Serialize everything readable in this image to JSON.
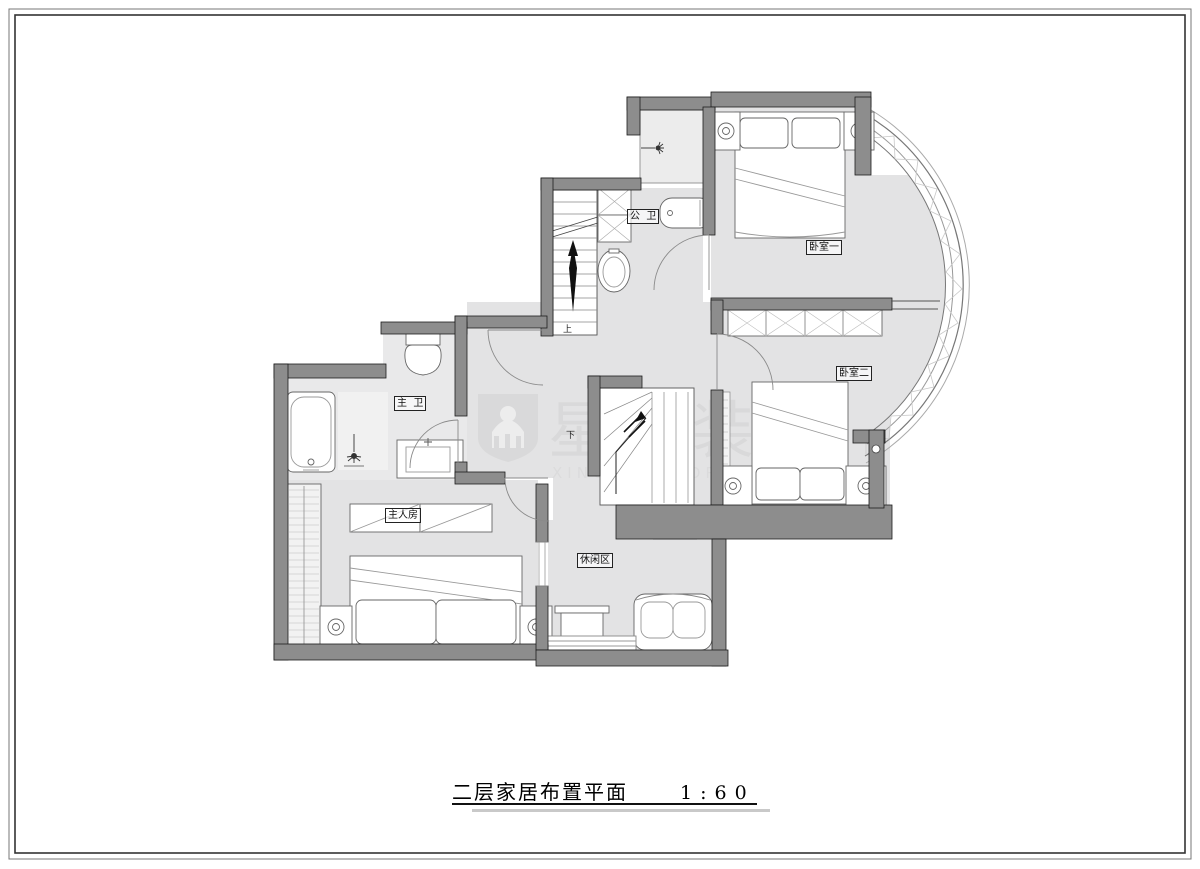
{
  "colors": {
    "wall": "#8d8d8d",
    "floor": "#e3e3e4",
    "bath_floor": "#ececec",
    "line": "#555555",
    "watermark": "#d2d2d2"
  },
  "title": {
    "text": "二层家居布置平面",
    "scale": "1:60"
  },
  "watermark": {
    "cn": "星艺装饰",
    "en": "XINGYI DECORATION"
  },
  "rooms": {
    "bedroom1": {
      "label": "卧室一"
    },
    "bedroom2": {
      "label": "卧室二"
    },
    "public_bath": {
      "label": "公  卫"
    },
    "master_bath": {
      "label": "主  卫"
    },
    "master_room": {
      "label": "主人房"
    },
    "leisure": {
      "label": "休闲区"
    }
  },
  "stairs": {
    "up": "上",
    "down": "下"
  }
}
